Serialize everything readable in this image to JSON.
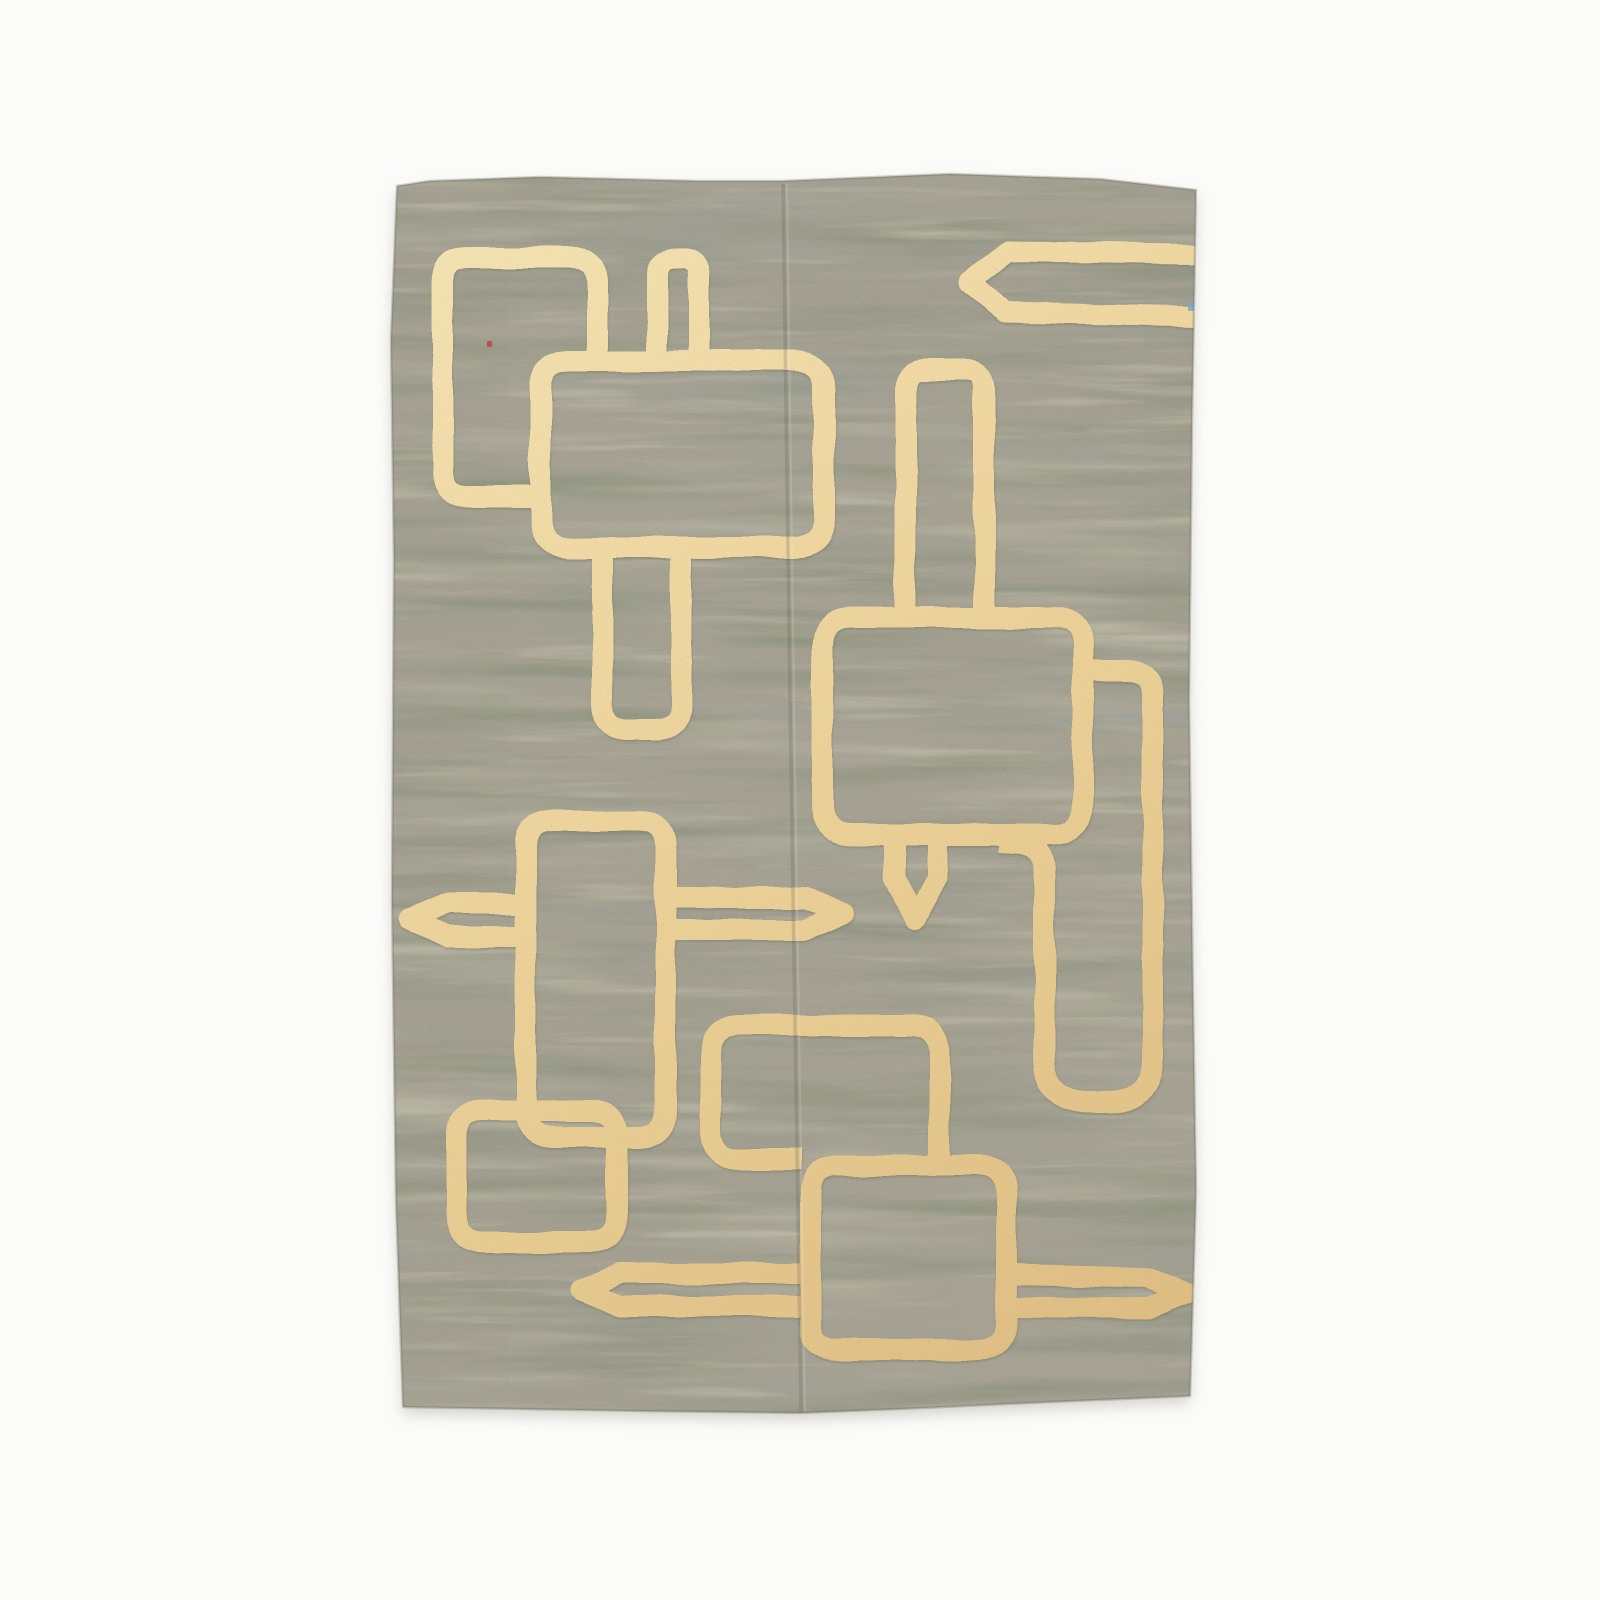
{
  "scene": {
    "type": "product-photo",
    "subject": "handwoven flatweave kilim area rug with cream geometric outline motifs on a sage grey-green field",
    "background_color": "#fbfbf9",
    "rug": {
      "bbox": {
        "x": 388,
        "y": 172,
        "width": 812,
        "height": 1242
      },
      "outline_points": "397,186 430,181 540,177 700,181 782,181 950,174 1100,179 1196,190 1192,420 1189,700 1193,1000 1196,1190 1190,1396 1050,1402 900,1409 800,1413 640,1411 520,1409 403,1407 396,1200 392,900 394,560 391,340",
      "field_base_color": "#a6a294",
      "edge_color": "rgba(96,99,84,0.30)",
      "shadow_color": "rgba(140,138,124,0.35)",
      "texture_layer_colors": [
        "#8f9180",
        "#78866c",
        "#c1bfab",
        "#93a3a6",
        "#ded9c3",
        "#525947",
        "#f4f0df"
      ],
      "motif_gradient": [
        {
          "offset": "0",
          "color": "#f2e2b2"
        },
        {
          "offset": "0.35",
          "color": "#eed59f"
        },
        {
          "offset": "0.65",
          "color": "#e6ca90"
        },
        {
          "offset": "1",
          "color": "#dcba80"
        }
      ],
      "motif_stroke_width": 21,
      "motifs": [
        {
          "name": "tall-rect-top-left",
          "d": "M 597.5 352 L 597.5 283 Q 597.5 257.5 572 257.5 L 468 257.5 Q 442.5 257.5 442.5 283 L 442.5 471 Q 442.5 496.5 468 496.5 L 530 496.5"
        },
        {
          "name": "square-top-center",
          "d": "M 570 360.5 L 794 360.5 Q 824.5 360.5 824.5 391 L 824.5 517 Q 824.5 547.5 794 547.5 L 571 547.5 Q 540.5 547.5 540.5 517 L 540.5 391 Q 540.5 360.5 570 360.5 Z"
        },
        {
          "name": "arch-stem-top-center",
          "d": "M 657.5 362 L 657.5 276 Q 657.5 257.5 676 257.5 L 681 257.5 Q 699.5 257.5 699.5 276 L 699.5 362"
        },
        {
          "name": "u-stem-below-top-square",
          "d": "M 602.5 546 L 602.5 705 Q 602.5 729.5 627 729.5 L 657 729.5 Q 681.5 729.5 681.5 705 L 681.5 546"
        },
        {
          "name": "tall-rect-mid-left",
          "d": "M 553 820.5 L 638 820.5 Q 665.5 820.5 665.5 848 L 665.5 1109 Q 665.5 1136.5 638 1136.5 L 553 1136.5 Q 525.5 1136.5 525.5 1109 L 525.5 848 Q 525.5 820.5 553 820.5 Z"
        },
        {
          "name": "pointed-bar-mid-left",
          "d": "M 518 903.5 L 448 903.5 L 409 920 L 448 936.5 L 518 936.5"
        },
        {
          "name": "pointed-bar-mid-center",
          "d": "M 673 897.5 L 806 897.5 L 843 913 L 806 929.5 L 673 929.5"
        },
        {
          "name": "rounded-square-bottom-left",
          "d": "M 483 1110.5 L 591 1110.5 Q 616.5 1110.5 616.5 1136 L 616.5 1217 Q 616.5 1242.5 591 1242.5 L 483 1242.5 Q 457.5 1242.5 457.5 1217 L 457.5 1136 Q 457.5 1110.5 483 1110.5 Z"
        },
        {
          "name": "large-square-right",
          "d": "M 852 617.5 L 1052 617.5 Q 1082.5 617.5 1082.5 648 L 1082.5 804 Q 1082.5 834.5 1052 834.5 L 853 834.5 Q 822.5 834.5 822.5 804 L 822.5 648 Q 822.5 617.5 852 617.5 Z"
        },
        {
          "name": "arch-stem-above-large-square",
          "d": "M 905.5 620 L 905.5 389 Q 905.5 370.5 924 370.5 L 966 370.5 Q 984.5 370.5 984.5 389 L 984.5 620"
        },
        {
          "name": "pointed-stem-below-large-square",
          "d": "M 893.5 833 L 893.5 878 L 915 918 L 936.5 878 L 936.5 833"
        },
        {
          "name": "hook-loop-right",
          "d": "M 1078 670.5 L 1128 670.5 Q 1152.5 670.5 1152.5 695 L 1152.5 1057 Q 1152.5 1102.5 1107 1102.5 L 1090 1102.5 Q 1044.5 1102.5 1044.5 1057 L 1044.5 872 Q 1044.5 845 1018 842 L 1000 841"
        },
        {
          "name": "rounded-square-bottom-center",
          "d": "M 939.5 1155 L 939.5 1056 Q 939.5 1025.5 909 1025.5 L 741 1025.5 Q 710.5 1025.5 710.5 1056 L 710.5 1129 Q 710.5 1159.5 741 1159.5 L 800 1159.5"
        },
        {
          "name": "square-bottom-right",
          "d": "M 838 1165.5 L 979 1165.5 Q 1006.5 1165.5 1006.5 1193 L 1006.5 1322 Q 1006.5 1349.5 979 1349.5 L 838 1349.5 Q 810.5 1349.5 810.5 1322 L 810.5 1193 Q 810.5 1165.5 838 1165.5 Z"
        },
        {
          "name": "pointed-bar-bottom-left",
          "d": "M 804 1273.5 L 620 1273.5 L 582 1290 L 620 1306.5 L 804 1306.5"
        },
        {
          "name": "pointed-bar-bottom-right",
          "d": "M 1013 1274.5 L 1148 1277.5 L 1186 1293 L 1148 1308.5 L 1013 1307"
        },
        {
          "name": "pointed-band-top-right",
          "d": "M 1198 254 L 1008 252 L 969 283 L 1006 312.5 L 1198 317",
          "w": 20
        }
      ],
      "seam": {
        "d": "M 783 184 L 790 700 L 801 1411",
        "dark_color": "rgba(86,92,76,0.22)",
        "light_color": "rgba(245,242,228,0.16)"
      },
      "flecks": [
        {
          "name": "red-weft-fleck",
          "x": 487,
          "y": 341,
          "w": 5,
          "h": 6,
          "color": "#b0483f"
        },
        {
          "name": "blue-weft-fleck",
          "x": 1188,
          "y": 302,
          "w": 6,
          "h": 9,
          "color": "#7fa8bd"
        }
      ]
    }
  }
}
